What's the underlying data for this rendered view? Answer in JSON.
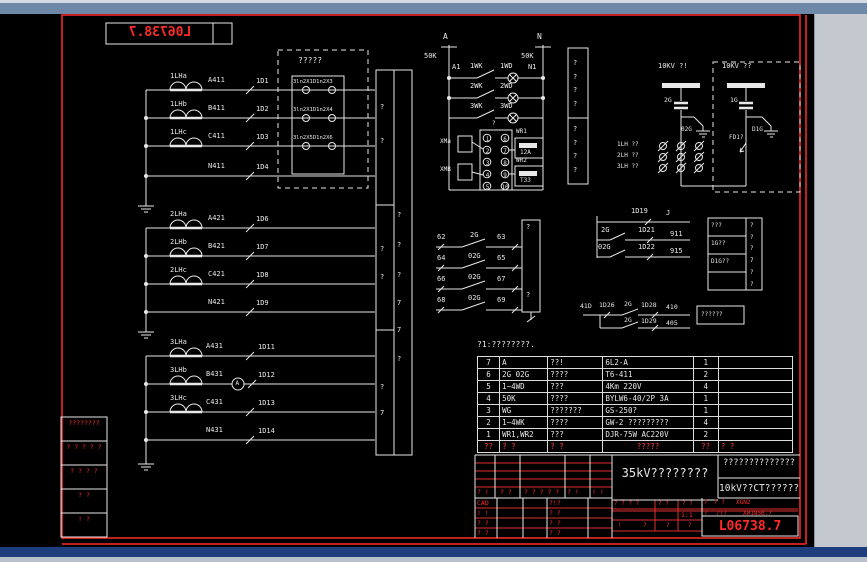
{
  "colors": {
    "canvas": "#000000",
    "line": "#e8e8e8",
    "accent_red": "#ff2a2a",
    "titlebar": "#6e88a7",
    "side_panel": "#c4c8cf",
    "status_bar": "#1e3e7e"
  },
  "top_title": {
    "text": "L06738.7"
  },
  "groups": [
    {
      "rows": [
        {
          "ct": "1LHa",
          "phase": "A411",
          "term": "1D1"
        },
        {
          "ct": "1LHb",
          "phase": "B411",
          "term": "1D2"
        },
        {
          "ct": "1LHc",
          "phase": "C411",
          "term": "1D3"
        },
        {
          "phase": "N411",
          "term": "1D4"
        }
      ]
    },
    {
      "rows": [
        {
          "ct": "2LHa",
          "phase": "A421",
          "term": "1D6"
        },
        {
          "ct": "2LHb",
          "phase": "B421",
          "term": "1D7"
        },
        {
          "ct": "2LHc",
          "phase": "C421",
          "term": "1D8"
        },
        {
          "phase": "N421",
          "term": "1D9"
        }
      ]
    },
    {
      "rows": [
        {
          "ct": "3LHa",
          "phase": "A431",
          "term": "1D11"
        },
        {
          "ct": "3LHb",
          "phase": "B431",
          "term": "1D12",
          "meter": "A"
        },
        {
          "ct": "3LHc",
          "phase": "C431",
          "term": "1D13"
        },
        {
          "phase": "N431",
          "term": "1D14"
        }
      ]
    }
  ],
  "junction_box": {
    "title": "?????",
    "rows": [
      "3ln2X1D1n2X3",
      "3ln2X1D1n2X4",
      "3ln2X5D1n2X6"
    ]
  },
  "terminal_strip": {
    "left": [
      "?",
      "?",
      "?",
      "?",
      "?",
      "7"
    ],
    "right": [
      "?",
      "?",
      "?",
      "7",
      "7",
      "?"
    ]
  },
  "lamp_circuit": {
    "bus_a": "A",
    "bus_n": "N",
    "fuse_a": "50K",
    "fuse_n": "50K",
    "node_a": "A1",
    "node_n": "N1",
    "block_tag": "?",
    "switches": [
      "1WK",
      "2WK",
      "3WK"
    ],
    "lamps": [
      "1WD",
      "2WD",
      "3WD"
    ],
    "terminals_left": "1\n2\n3\n4\n5",
    "terminals_right": "6\n7\n8\n9\n10",
    "sockets": [
      "XMa",
      "XMB"
    ],
    "heaters": [
      {
        "name": "WR1",
        "value": "12A"
      },
      {
        "name": "WR2",
        "value": "T33"
      }
    ]
  },
  "aux_contacts": [
    {
      "left": "62",
      "switch": "2G",
      "right": "63"
    },
    {
      "left": "64",
      "switch": "02G",
      "right": "65"
    },
    {
      "left": "66",
      "switch": "02G",
      "right": "67"
    },
    {
      "left": "68",
      "switch": "02G",
      "right": "69"
    }
  ],
  "contact_box": {
    "top": "?",
    "bottom": "?"
  },
  "qbox": {
    "top": "?\n?\n?\n?",
    "bottom": "?\n?\n?\n?"
  },
  "hv_left": {
    "bus": "10KV ?!",
    "isolator": "2G",
    "earth_switch": "02G",
    "ct_labels": [
      "1LH ??",
      "2LH ??",
      "3LH ??"
    ]
  },
  "hv_right": {
    "bus": "10KV ??",
    "isolator": "1G",
    "earth_switch": "D1G",
    "feeder": "FD1?"
  },
  "signal_lines": [
    {
      "term": "1D19",
      "tag": "J"
    },
    {
      "switch": "2G",
      "term": "1D21",
      "tag": "911"
    },
    {
      "switch": "02G",
      "term": "1D22",
      "tag": "915"
    }
  ],
  "signal_box": {
    "rows": [
      "???",
      "1G??",
      "D1G??"
    ],
    "marks": "?\n?\n?\n7\n?\n?"
  },
  "trip": {
    "l1_pre": "41D",
    "l1_term1": "1D26",
    "l1_switch": "2G",
    "l1_term2": "1D28",
    "l1_tag": "410",
    "l2_switch": "2G",
    "l2_term": "1D29",
    "l2_tag": "405",
    "box_label": "??????"
  },
  "bom": {
    "note": "?1:????????.",
    "header": [
      "??",
      "? ?",
      "? ?",
      "?????",
      "??",
      "? ?"
    ],
    "rows": [
      [
        "7",
        "A",
        "??!",
        "6L2-A",
        "1",
        ""
      ],
      [
        "6",
        "2G 02G",
        "????",
        "T6-411",
        "2",
        ""
      ],
      [
        "5",
        "1~4WD",
        "???",
        "4Km 220V",
        "4",
        ""
      ],
      [
        "4",
        "50K",
        "????",
        "BYLW6-40/2P 3A",
        "1",
        ""
      ],
      [
        "3",
        "WG",
        "???????",
        "GS-250?",
        "1",
        ""
      ],
      [
        "2",
        "1~4WK",
        "????",
        "GW-2 ?????????",
        "4",
        ""
      ],
      [
        "1",
        "WR1,WR2",
        "???",
        "DJR-75W AC220V",
        "2",
        ""
      ]
    ]
  },
  "revisions": [
    "????????",
    "? ? ? ? ?",
    "? ? ? ?",
    "? ?",
    "! ?"
  ],
  "titleblock": {
    "sig_row": [
      "? !",
      "? ?",
      "? ? ? ? ?",
      "? !",
      "! !"
    ],
    "cad": "CAD",
    "cad_right": "?!?",
    "b_rows": [
      [
        "! !",
        "? ?"
      ],
      [
        "? ?",
        "? ?"
      ],
      [
        "? ?",
        "? ?"
      ]
    ],
    "product": "35kV????????",
    "title1": "??????????????",
    "title2": "10kV??CT??????",
    "scale_cells": [
      "? ? ? ?",
      "? ?",
      "? ?"
    ],
    "scale": "1:1",
    "bottom_cells": [
      "!",
      "?",
      "?",
      "?"
    ],
    "tiny1": "?",
    "tiny2": "?",
    "mini1": "? ?",
    "code1": "XGN2",
    "mini2": "?!?",
    "code2": "X01850.7",
    "drawing_no": "L06738.7"
  }
}
